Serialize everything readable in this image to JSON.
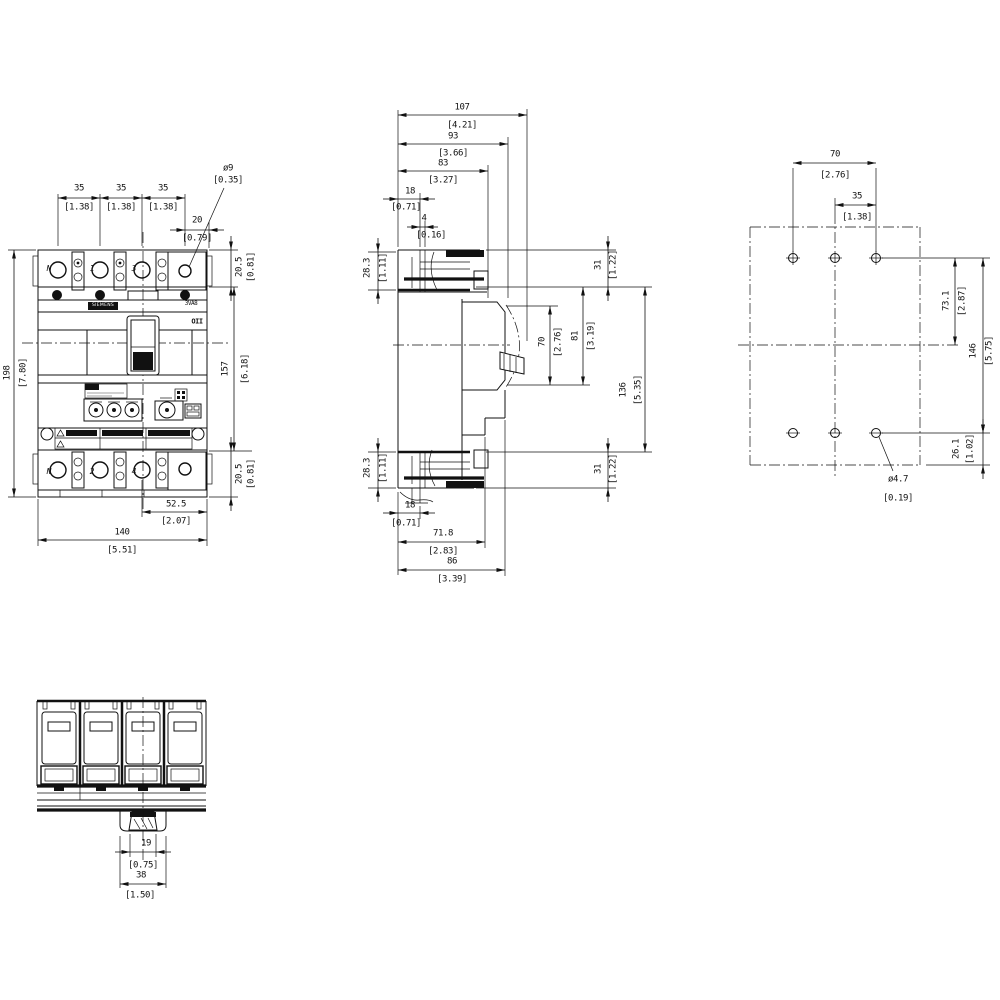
{
  "palette": {
    "line": "#111111",
    "background": "#ffffff"
  },
  "views": {
    "front": {
      "brand_label": "SIEMENS",
      "product_label": "3VA8",
      "switch_marking": "OII",
      "terminals_top": [
        "N",
        "1",
        "3"
      ],
      "terminals_bottom": [
        "N",
        "2",
        "4"
      ],
      "dims": {
        "pole_pitch_1": {
          "mm": "35",
          "inch": "[1.38]"
        },
        "pole_pitch_2": {
          "mm": "35",
          "inch": "[1.38]"
        },
        "pole_pitch_3": {
          "mm": "35",
          "inch": "[1.38]"
        },
        "hole_offset": {
          "mm": "20",
          "inch": "[0.79]"
        },
        "hole_dia": {
          "mm": "ø9",
          "inch": "[0.35]"
        },
        "terminal_height_top": {
          "mm": "20.5",
          "inch": "[0.81]"
        },
        "overall_height": {
          "mm": "198",
          "inch": "[7.80]"
        },
        "body_height": {
          "mm": "157",
          "inch": "[6.18]"
        },
        "terminal_height_bottom": {
          "mm": "20.5",
          "inch": "[0.81]"
        },
        "right_width": {
          "mm": "52.5",
          "inch": "[2.07]"
        },
        "overall_width": {
          "mm": "140",
          "inch": "[5.51]"
        }
      }
    },
    "side": {
      "dims": {
        "overall_depth": {
          "mm": "107",
          "inch": "[4.21]"
        },
        "depth_93": {
          "mm": "93",
          "inch": "[3.66]"
        },
        "depth_83": {
          "mm": "83",
          "inch": "[3.27]"
        },
        "top_18": {
          "mm": "18",
          "inch": "[0.71]"
        },
        "top_4": {
          "mm": "4",
          "inch": "[0.16]"
        },
        "lug_top": {
          "mm": "28.3",
          "inch": "[1.11]"
        },
        "top_31": {
          "mm": "31",
          "inch": "[1.22]"
        },
        "handle_70": {
          "mm": "70",
          "inch": "[2.76]"
        },
        "handle_81": {
          "mm": "81",
          "inch": "[3.19]"
        },
        "mid_136": {
          "mm": "136",
          "inch": "[5.35]"
        },
        "bottom_31": {
          "mm": "31",
          "inch": "[1.22]"
        },
        "lug_bottom": {
          "mm": "28.3",
          "inch": "[1.11]"
        },
        "bottom_18": {
          "mm": "18",
          "inch": "[0.71]"
        },
        "depth_71_8": {
          "mm": "71.8",
          "inch": "[2.83]"
        },
        "depth_86": {
          "mm": "86",
          "inch": "[3.39]"
        }
      }
    },
    "drill": {
      "dims": {
        "hole_pitch_70": {
          "mm": "70",
          "inch": "[2.76]"
        },
        "hole_pitch_35": {
          "mm": "35",
          "inch": "[1.38]"
        },
        "vert_73_1": {
          "mm": "73.1",
          "inch": "[2.87]"
        },
        "vert_146": {
          "mm": "146",
          "inch": "[5.75]"
        },
        "vert_26_1": {
          "mm": "26.1",
          "inch": "[1.02]"
        },
        "hole_dia": {
          "mm": "ø4.7",
          "inch": "[0.19]"
        }
      }
    },
    "bottom": {
      "dims": {
        "handle_19": {
          "mm": "19",
          "inch": "[0.75]"
        },
        "handle_38": {
          "mm": "38",
          "inch": "[1.50]"
        }
      }
    }
  }
}
